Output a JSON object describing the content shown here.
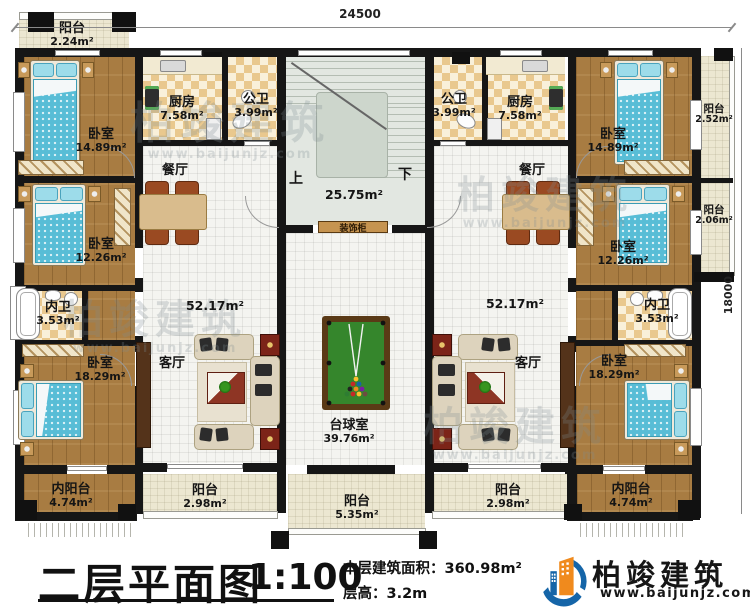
{
  "dimensions": {
    "top": "24500",
    "right": "18000"
  },
  "stair_hall": {
    "area": "25.75m²",
    "up": "上",
    "down": "下",
    "cabinet": "装饰柜"
  },
  "rooms": {
    "balcony_tl": {
      "name": "阳台",
      "area": "2.24m²"
    },
    "bedroom_tl": {
      "name": "卧室",
      "area": "14.89m²"
    },
    "kitchen_l": {
      "name": "厨房",
      "area": "7.58m²"
    },
    "bath_public_l": {
      "name": "公卫",
      "area": "3.99m²"
    },
    "bath_public_r": {
      "name": "公卫",
      "area": "3.99m²"
    },
    "kitchen_r": {
      "name": "厨房",
      "area": "7.58m²"
    },
    "bedroom_tr": {
      "name": "卧室",
      "area": "14.89m²"
    },
    "balcony_tr": {
      "name": "阳台",
      "area": "2.52m²"
    },
    "dining_l": {
      "name": "餐厅"
    },
    "dining_r": {
      "name": "餐厅"
    },
    "hall_area_l": {
      "area": "52.17m²"
    },
    "hall_area_r": {
      "area": "52.17m²"
    },
    "bedroom_ml": {
      "name": "卧室",
      "area": "12.26m²"
    },
    "bedroom_mr": {
      "name": "卧室",
      "area": "12.26m²"
    },
    "balcony_mr": {
      "name": "阳台",
      "area": "2.06m²"
    },
    "bath_inner_l": {
      "name": "内卫",
      "area": "3.53m²"
    },
    "bath_inner_r": {
      "name": "内卫",
      "area": "3.53m²"
    },
    "bedroom_bl": {
      "name": "卧室",
      "area": "18.29m²"
    },
    "bedroom_br": {
      "name": "卧室",
      "area": "18.29m²"
    },
    "living_l": {
      "name": "客厅"
    },
    "living_r": {
      "name": "客厅"
    },
    "billiard": {
      "name": "台球室",
      "area": "39.76m²"
    },
    "inner_balcony_l": {
      "name": "内阳台",
      "area": "4.74m²"
    },
    "inner_balcony_r": {
      "name": "内阳台",
      "area": "4.74m²"
    },
    "balcony_bl": {
      "name": "阳台",
      "area": "2.98m²"
    },
    "balcony_bc": {
      "name": "阳台",
      "area": "5.35m²"
    },
    "balcony_br": {
      "name": "阳台",
      "area": "2.98m²"
    }
  },
  "title_block": {
    "title": "二层平面图",
    "scale": "1:100",
    "area_note": "本层建筑面积：360.98m²",
    "height_note": "层高：3.2m"
  },
  "logo": {
    "name": "柏竣建筑",
    "url": "www.baijunjz.com"
  },
  "watermark": {
    "text": "柏竣建筑",
    "sub": "www.baijunjz.com"
  },
  "colors": {
    "wall": "#161616",
    "wood": "#a87c42",
    "billiard_green": "#35862c",
    "accent_orange": "#f08a1d",
    "accent_blue": "#1565a8"
  }
}
